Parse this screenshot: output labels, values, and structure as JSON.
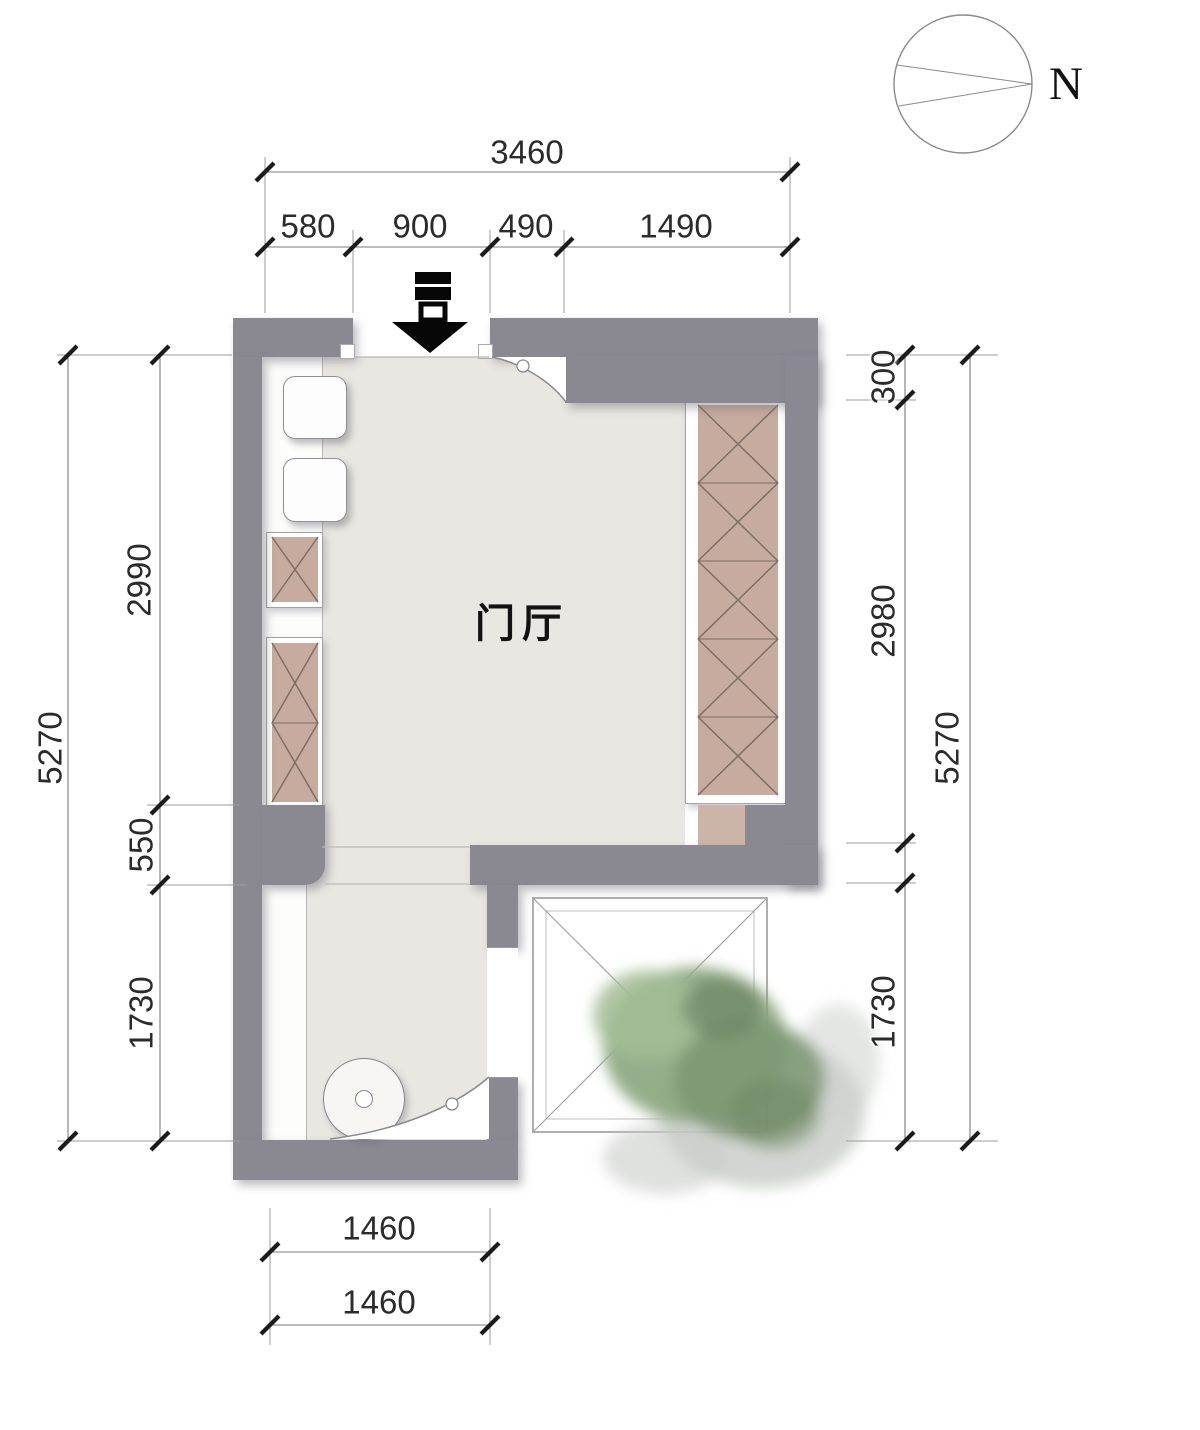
{
  "room": {
    "name": "门厅"
  },
  "compass": {
    "north": "N"
  },
  "dimensions": {
    "top": {
      "total": "3460",
      "segments": [
        "580",
        "900",
        "490",
        "1490"
      ]
    },
    "left": {
      "overall": "5270",
      "segments": [
        "2990",
        "550",
        "1730"
      ]
    },
    "right": {
      "overall": "5270",
      "segments": [
        "300",
        "2980",
        "1730"
      ]
    },
    "bottom": {
      "outer": "1460",
      "inner": "1460"
    }
  },
  "palette": {
    "wall": "#8a8992",
    "floor": "#e9e7e1",
    "cabinet": "#c6ab9e",
    "tree_green": "#8fa983",
    "dimension_text": "#2b2b2b"
  }
}
